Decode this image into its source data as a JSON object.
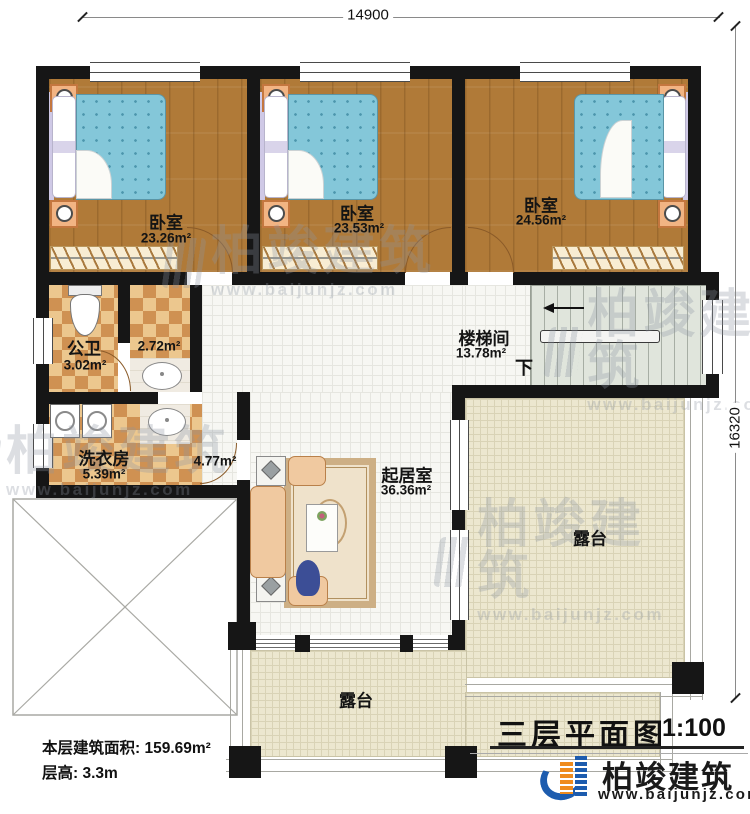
{
  "plan": {
    "dim_top": "14900",
    "dim_right": "16320",
    "stair_down": "下"
  },
  "rooms": {
    "bedroom1": {
      "name": "卧室",
      "area": "23.26m²"
    },
    "bedroom2": {
      "name": "卧室",
      "area": "23.53m²"
    },
    "bedroom3": {
      "name": "卧室",
      "area": "24.56m²"
    },
    "bathroom": {
      "name": "公卫",
      "area": "3.02m²"
    },
    "vestibule": {
      "area": "2.72m²"
    },
    "laundry": {
      "name": "洗衣房",
      "area": "5.39m²"
    },
    "hallway": {
      "area": "4.77m²"
    },
    "stairwell": {
      "name": "楼梯间",
      "area": "13.78m²"
    },
    "living": {
      "name": "起居室",
      "area": "36.36m²"
    },
    "terrace_right": {
      "name": "露台"
    },
    "terrace_bottom": {
      "name": "露台"
    }
  },
  "annotations": {
    "floor_area": "本层建筑面积: 159.69m²",
    "floor_height": "层高: 3.3m"
  },
  "title_block": {
    "title": "三层平面图",
    "scale": "1:100"
  },
  "brand": {
    "name": "柏竣建筑",
    "website": "www.baijunjz.com"
  },
  "watermark": {
    "name": "柏竣建筑",
    "website": "www.baijunjz.com"
  }
}
